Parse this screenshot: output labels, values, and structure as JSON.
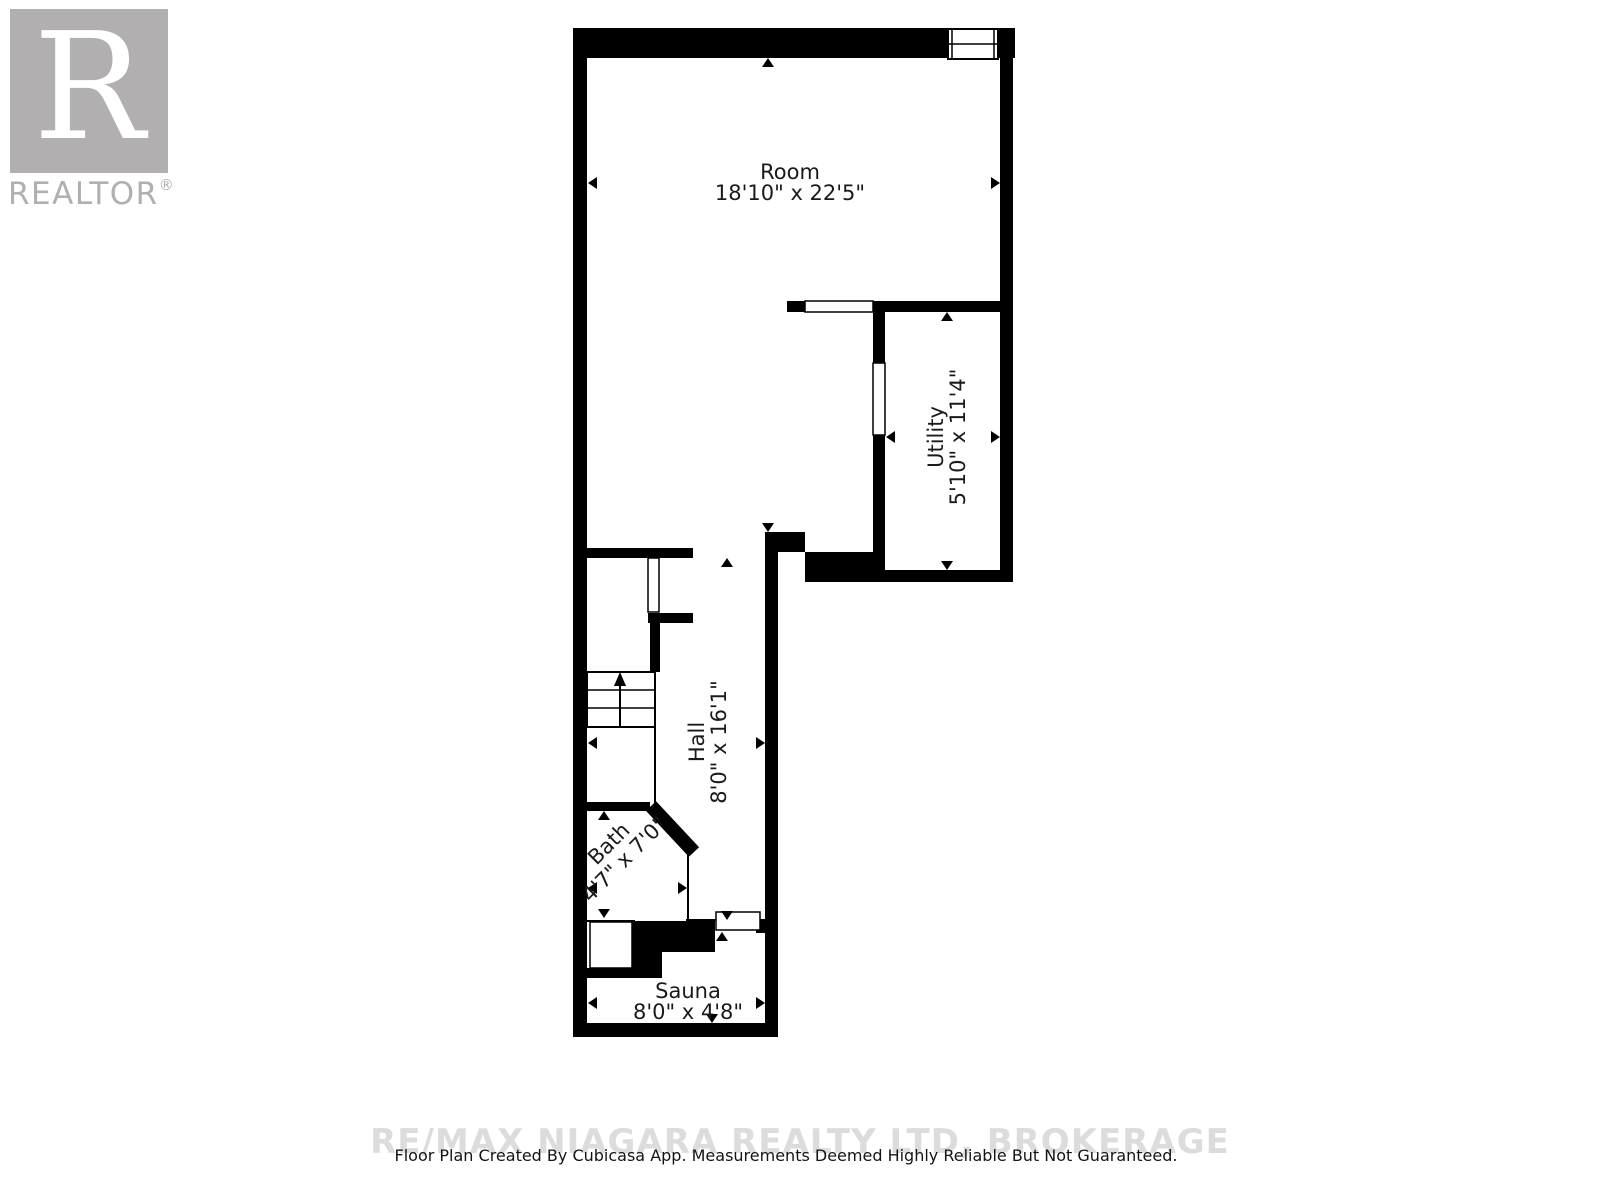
{
  "logo": {
    "letter": "R",
    "brand": "REALTOR",
    "reg": "®"
  },
  "rooms": [
    {
      "name": "Room",
      "dims": "18'10\" x 22'5\""
    },
    {
      "name": "Utility",
      "dims": "5'10\" x 11'4\""
    },
    {
      "name": "Hall",
      "dims": "8'0\" x 16'1\""
    },
    {
      "name": "Bath",
      "dims": "4'7\" x 7'0\""
    },
    {
      "name": "Sauna",
      "dims": "8'0\" x 4'8\""
    }
  ],
  "watermark": "RE/MAX NIAGARA REALTY LTD, BROKERAGE",
  "footer": "Floor Plan Created By Cubicasa App. Measurements Deemed Highly Reliable But Not Guaranteed.",
  "colors": {
    "wall": "#000000",
    "label_text": "#1a1a1a",
    "logo_gray": "#b1afaf",
    "watermark_gray": "#dcdcdc"
  },
  "icons": [
    "up-arrow",
    "down-arrow",
    "left-arrow",
    "right-arrow",
    "stairs-up-arrow",
    "window",
    "door-opening"
  ]
}
